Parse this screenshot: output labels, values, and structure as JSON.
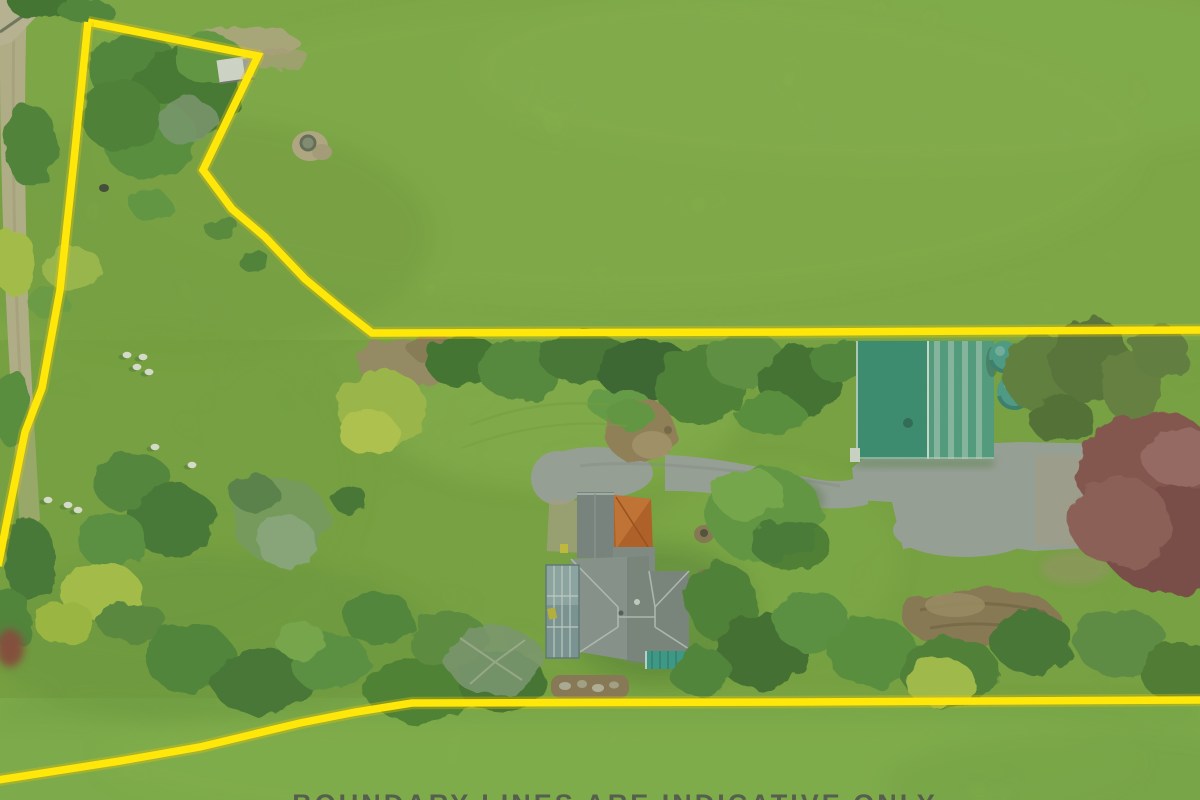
{
  "meta": {
    "description": "Aerial drone photograph of a rural lifestyle property with a yellow surveyed-boundary overlay, house with gray hip roof, green farm shed, curved driveway, paddocks with sheep and mature trees",
    "width": 1200,
    "height": 800
  },
  "palette": {
    "boundary_yellow": "#FFE70A",
    "boundary_glow": "#E8C400",
    "field_top": "#8CBB49",
    "field_mid": "#82B141",
    "field_bottom": "#8CC04E",
    "lawn_bright": "#97C553",
    "tree_dark": "#38702C",
    "tree_mid": "#4C8637",
    "tree_light": "#66A344",
    "bush_yellow": "#B3CB47",
    "olive_tree": "#78A061",
    "conifer": "#5D7E3B",
    "red_tree": "#8A4A50",
    "dead_brown": "#A08B6A",
    "log_brown": "#8F7454",
    "garden_soil": "#9B7E5C",
    "driveway": "#A3A7AA",
    "gravel_tan": "#B3A590",
    "dirt_road": "#C9BA9F",
    "roof_gray": "#8E969C",
    "roof_gray_dark": "#757D83",
    "garage_gray": "#7A838A",
    "roof_orange": "#C2561D",
    "roof_orange_light": "#D96E2E",
    "conservatory_blue": "#7E98A6",
    "shed_teal": "#2F8F7B",
    "shed_teal_light": "#4DA28C",
    "skylight_pale": "#8CC3B4",
    "tank_teal": "#46A096",
    "bin_blue": "#3A6BB5",
    "pool_teal": "#2E9E96",
    "sheep_white": "#F4F4EE",
    "shadow_green": "#2F5F2A",
    "white_trim": "#E9EAE8",
    "text_gray": "#4E4E4E"
  },
  "boundary": {
    "stroke_width": 7.5,
    "segments": [
      {
        "name": "north",
        "points": [
          [
            88,
            22
          ],
          [
            258,
            56
          ],
          [
            203,
            170
          ],
          [
            232,
            209
          ],
          [
            265,
            237
          ],
          [
            305,
            279
          ],
          [
            340,
            308
          ],
          [
            372,
            333
          ],
          [
            800,
            332
          ],
          [
            1200,
            330
          ]
        ]
      },
      {
        "name": "west",
        "points": [
          [
            88,
            22
          ],
          [
            74,
            160
          ],
          [
            60,
            290
          ],
          [
            42,
            388
          ],
          [
            25,
            432
          ],
          [
            10,
            506
          ],
          [
            -2,
            566
          ]
        ]
      },
      {
        "name": "south",
        "points": [
          [
            -2,
            780
          ],
          [
            120,
            761
          ],
          [
            200,
            747
          ],
          [
            300,
            723
          ],
          [
            356,
            712
          ],
          [
            412,
            703
          ],
          [
            800,
            702
          ],
          [
            1200,
            700
          ]
        ]
      }
    ]
  },
  "sheep": {
    "count": 9,
    "positions": [
      [
        127,
        355
      ],
      [
        143,
        357
      ],
      [
        137,
        367
      ],
      [
        149,
        372
      ],
      [
        155,
        447
      ],
      [
        192,
        465
      ],
      [
        48,
        500
      ],
      [
        68,
        505
      ],
      [
        78,
        510
      ]
    ]
  },
  "scene_elements": [
    "neighbor-pasture-top",
    "property-grounds",
    "front-paddock-bottom",
    "dirt-access-road",
    "small-white-shed",
    "water-trough",
    "top-left-tree-cluster",
    "hedgerow",
    "dead-bush",
    "conifer-trees",
    "red-maple-tree",
    "silver-olive-tree",
    "bare-winter-tree",
    "yellow-green-bushes",
    "sheep-flock",
    "driveway",
    "shed-forecourt",
    "circular-garden-bed",
    "lawn-tree",
    "house",
    "garage-roof",
    "orange-roof-section",
    "main-hip-roof",
    "conservatory",
    "pool-cover",
    "stone-garden-bed",
    "green-shed-roof",
    "roof-skylight-panels",
    "water-tank",
    "wheelie-bin",
    "log-pile",
    "red-trailer",
    "fire-pit"
  ],
  "disclaimer": {
    "text": "BOUNDARY LINES ARE INDICATIVE ONLY",
    "note": "caption cropped at bottom edge of photo"
  }
}
